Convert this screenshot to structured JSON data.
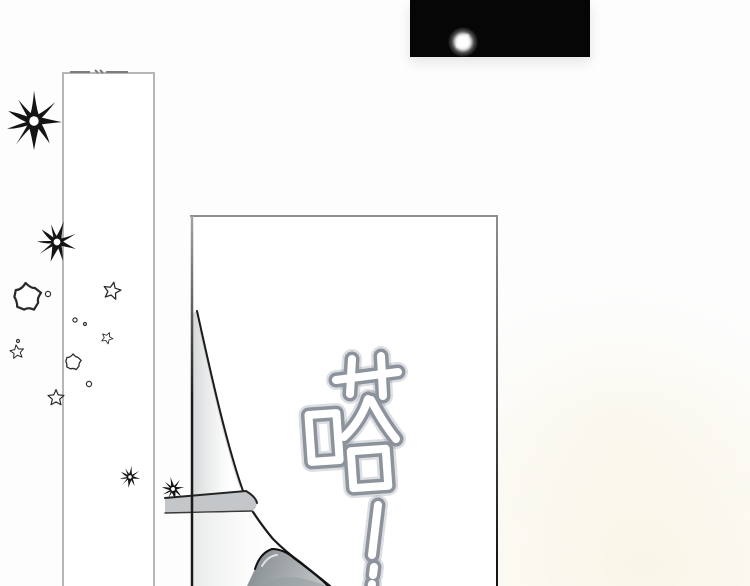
{
  "colors": {
    "bg": "#fdfdfd",
    "strip": "#060606",
    "glow": "#ffffff",
    "panel-border": "#b6b6b6",
    "panel-border-dark": "#1a1a1a",
    "ink": "#1a1a1a",
    "band": "#c3c7c9",
    "flap-dark": "#878e92",
    "flap-light": "#c6cacc",
    "sfx-outline": "#8b939c",
    "sfx-fill": "#ffffff",
    "warm-tint": "#f6f0d6"
  },
  "sfx": {
    "character": "嗒",
    "exclamation": "!",
    "text": "嗒!"
  },
  "decorations": {
    "glow_dot_icon": "glow-dot",
    "starburst_icon": "starburst",
    "outline_star_icon": "outline-star",
    "sparkle_dot_icon": "sparkle-dot",
    "starburst_count": 4,
    "outline_star_count": 6,
    "sparkle_dot_count": 5
  }
}
